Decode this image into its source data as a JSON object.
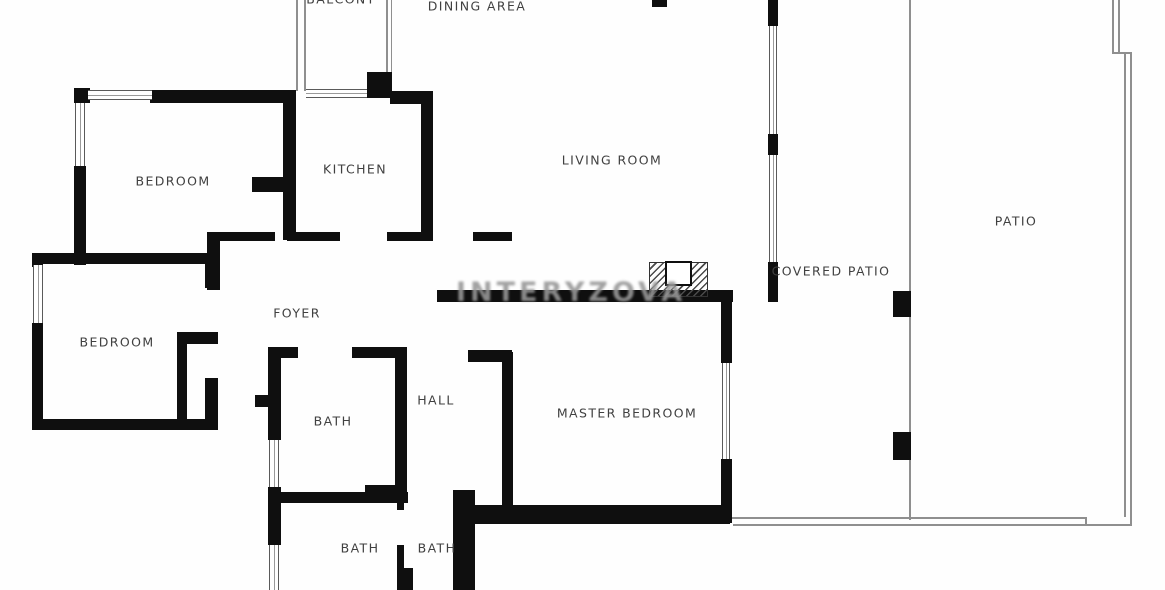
{
  "title": "Apartment floor plan",
  "rooms": [
    {
      "id": "balcony",
      "label": "BALCONY"
    },
    {
      "id": "dining-area",
      "label": "DINING AREA"
    },
    {
      "id": "bedroom-1",
      "label": "BEDROOM"
    },
    {
      "id": "kitchen",
      "label": "KITCHEN"
    },
    {
      "id": "living-room",
      "label": "LIVING ROOM"
    },
    {
      "id": "patio",
      "label": "PATIO"
    },
    {
      "id": "covered-patio",
      "label": "COVERED PATIO"
    },
    {
      "id": "foyer",
      "label": "FOYER"
    },
    {
      "id": "bedroom-2",
      "label": "BEDROOM"
    },
    {
      "id": "bath-1",
      "label": "BATH"
    },
    {
      "id": "hall",
      "label": "HALL"
    },
    {
      "id": "master-bedroom",
      "label": "MASTER BEDROOM"
    },
    {
      "id": "bath-2",
      "label": "BATH"
    },
    {
      "id": "bath-3",
      "label": "BATH"
    }
  ],
  "watermark": {
    "text": "INTERYZOVA"
  },
  "colors": {
    "wall": "#0f0f0f",
    "label_text": "#404040",
    "thin_line": "#8f8f8f",
    "background": "#fefefe",
    "watermark": "#989898"
  }
}
